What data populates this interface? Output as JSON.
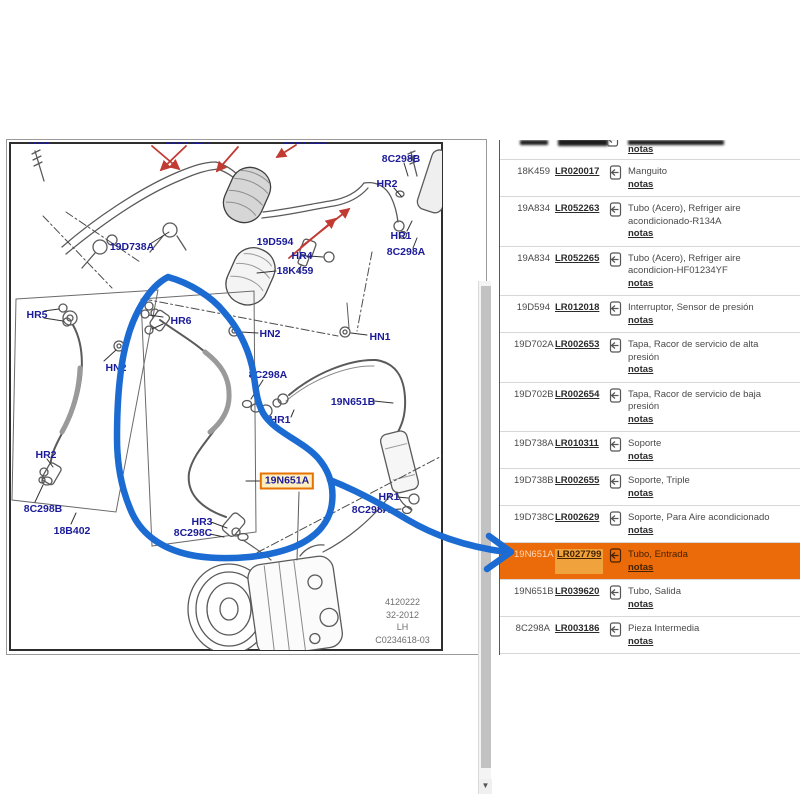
{
  "colors": {
    "accent_orange": "#EB6A09",
    "highlight_link_bg": "#F0A23C",
    "highlight_text_dark": "#462200",
    "highlight_code_text": "#FFD8B5",
    "label_navy": "#1B1B99",
    "leader_red": "#C23B33",
    "annotation_blue": "#1C6BD2",
    "link_color": "#2B2B2B",
    "text_grey": "#4A4A4A",
    "callout_box_border": "#E87200",
    "callout_box_bg": "#FDEFC2"
  },
  "diagram": {
    "footer_lines": [
      "4120222",
      "32-2012",
      "LH",
      "C0234618-03"
    ],
    "labels": [
      {
        "text": "HB1",
        "x": 39,
        "y": 141,
        "variant": "clip"
      },
      {
        "text": "19D702A",
        "x": 187,
        "y": 141,
        "variant": "clip"
      },
      {
        "text": "19D702B",
        "x": 305,
        "y": 141,
        "variant": "clip"
      },
      {
        "text": "8C298B",
        "x": 401,
        "y": 159
      },
      {
        "text": "HR2",
        "x": 387,
        "y": 184
      },
      {
        "text": "19D738A",
        "x": 132,
        "y": 247
      },
      {
        "text": "19D594",
        "x": 275,
        "y": 242
      },
      {
        "text": "HR1",
        "x": 401,
        "y": 236
      },
      {
        "text": "8C298A",
        "x": 406,
        "y": 252
      },
      {
        "text": "HR4",
        "x": 302,
        "y": 256
      },
      {
        "text": "18K459",
        "x": 295,
        "y": 271
      },
      {
        "text": "HR5",
        "x": 37,
        "y": 315
      },
      {
        "text": "HR6",
        "x": 181,
        "y": 321
      },
      {
        "text": "HN2",
        "x": 270,
        "y": 334
      },
      {
        "text": "HN1",
        "x": 380,
        "y": 337
      },
      {
        "text": "HN2",
        "x": 116,
        "y": 368
      },
      {
        "text": "8C298A",
        "x": 268,
        "y": 375
      },
      {
        "text": "19N651B",
        "x": 353,
        "y": 402
      },
      {
        "text": "HR1",
        "x": 280,
        "y": 420
      },
      {
        "text": "HR2",
        "x": 46,
        "y": 455
      },
      {
        "text": "19N651A",
        "x": 287,
        "y": 481,
        "variant": "box"
      },
      {
        "text": "HR1",
        "x": 389,
        "y": 497
      },
      {
        "text": "8C298B",
        "x": 43,
        "y": 509
      },
      {
        "text": "8C298A",
        "x": 371,
        "y": 510
      },
      {
        "text": "HR3",
        "x": 202,
        "y": 522
      },
      {
        "text": "18B402",
        "x": 72,
        "y": 531
      },
      {
        "text": "8C298C",
        "x": 193,
        "y": 533
      }
    ]
  },
  "scrollbar": {
    "down_arrow": "▼"
  },
  "table": {
    "partial_row": {
      "notes_label": "notas"
    },
    "rows": [
      {
        "code": "18K459",
        "part": "LR020017",
        "desc": "Manguito",
        "notes": "notas"
      },
      {
        "code": "19A834",
        "part": "LR052263",
        "desc": "Tubo (Acero), Refriger aire acondicionado-R134A",
        "notes": "notas"
      },
      {
        "code": "19A834",
        "part": "LR052265",
        "desc": "Tubo (Acero), Refriger aire acondicion-HF01234YF",
        "notes": "notas"
      },
      {
        "code": "19D594",
        "part": "LR012018",
        "desc": "Interruptor, Sensor de presión",
        "notes": "notas"
      },
      {
        "code": "19D702A",
        "part": "LR002653",
        "desc": "Tapa, Racor de servicio de alta presión",
        "notes": "notas"
      },
      {
        "code": "19D702B",
        "part": "LR002654",
        "desc": "Tapa, Racor de servicio de baja presión",
        "notes": "notas"
      },
      {
        "code": "19D738A",
        "part": "LR010311",
        "desc": "Soporte",
        "notes": "notas"
      },
      {
        "code": "19D738B",
        "part": "LR002655",
        "desc": "Soporte, Triple",
        "notes": "notas"
      },
      {
        "code": "19D738C",
        "part": "LR002629",
        "desc": "Soporte, Para Aire acondicionado",
        "notes": "notas"
      },
      {
        "code": "19N651A",
        "part": "LR027799",
        "desc": "Tubo, Entrada",
        "notes": "notas",
        "highlighted": true
      },
      {
        "code": "19N651B",
        "part": "LR039620",
        "desc": "Tubo, Salida",
        "notes": "notas"
      },
      {
        "code": "8C298A",
        "part": "LR003186",
        "desc": "Pieza Intermedia",
        "notes": "notas"
      }
    ]
  }
}
